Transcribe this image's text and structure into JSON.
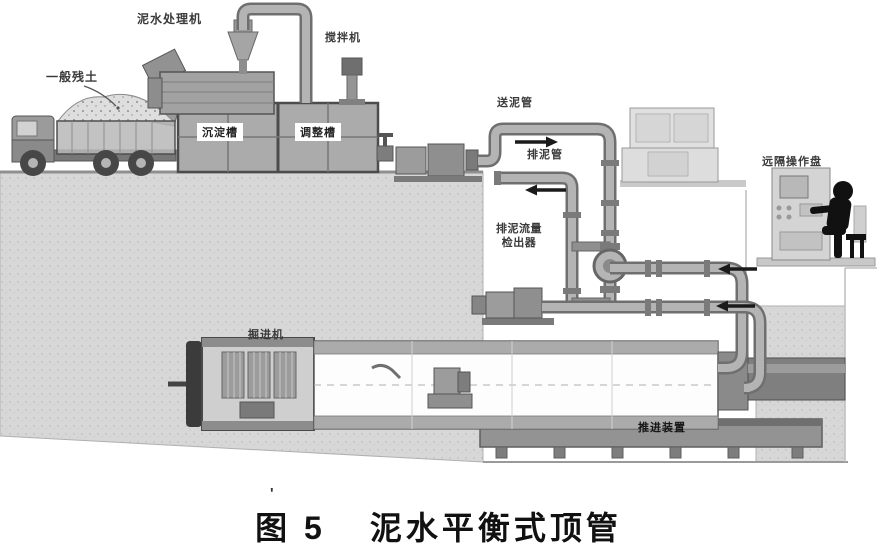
{
  "figure": {
    "caption_prefix": "图 5",
    "caption_title": "泥水平衡式顶管",
    "stray_mark": "'"
  },
  "labels": {
    "slurry_treatment_machine": "泥水处理机",
    "mixer": "搅拌机",
    "general_soil": "一般残土",
    "sedimentation_tank": "沉淀槽",
    "adjustment_tank": "调整槽",
    "feed_pipe": "送泥管",
    "discharge_pipe": "排泥管",
    "flow_detector_line1": "排泥流量",
    "flow_detector_line2": "检出器",
    "remote_panel": "远隔操作盘",
    "tbm": "掘进机",
    "jacking_device": "推进装置"
  },
  "colors": {
    "ground": "#d7d7d7",
    "equipment_gray": "#a8a8a8",
    "dark_steel": "#3b3b3b",
    "arrow": "#1a1a1a",
    "caption_text": "#111111"
  }
}
